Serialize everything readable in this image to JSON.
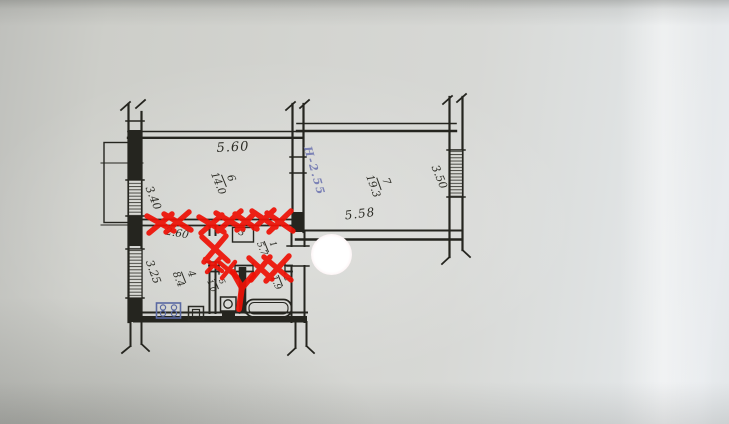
{
  "plan": {
    "rooms": {
      "living1": {
        "number": "6",
        "area": "14.0"
      },
      "living2": {
        "number": "7",
        "area": "19.3"
      },
      "kitchen": {
        "number": "4",
        "area": "8.4"
      },
      "hallway": {
        "number": "1",
        "area": "5.7"
      },
      "bathroom": {
        "number": "2",
        "area": "1.9"
      },
      "wc": {
        "number": "5",
        "area": "1.0"
      },
      "closet": {
        "number": "3"
      }
    },
    "dimensions": {
      "living1_width": "5.60",
      "living1_depth": "3.40",
      "kitchen_width": "2.60",
      "kitchen_depth": "3.25",
      "living2_width": "5.58",
      "living2_depth": "3.50"
    },
    "notes": {
      "ceiling_height": "H-2.55"
    },
    "colors": {
      "ink": "#25251f",
      "demolition_red": "#ee1207",
      "blue_ink": "#7b81b5",
      "paper": "#d3d4d0"
    }
  }
}
